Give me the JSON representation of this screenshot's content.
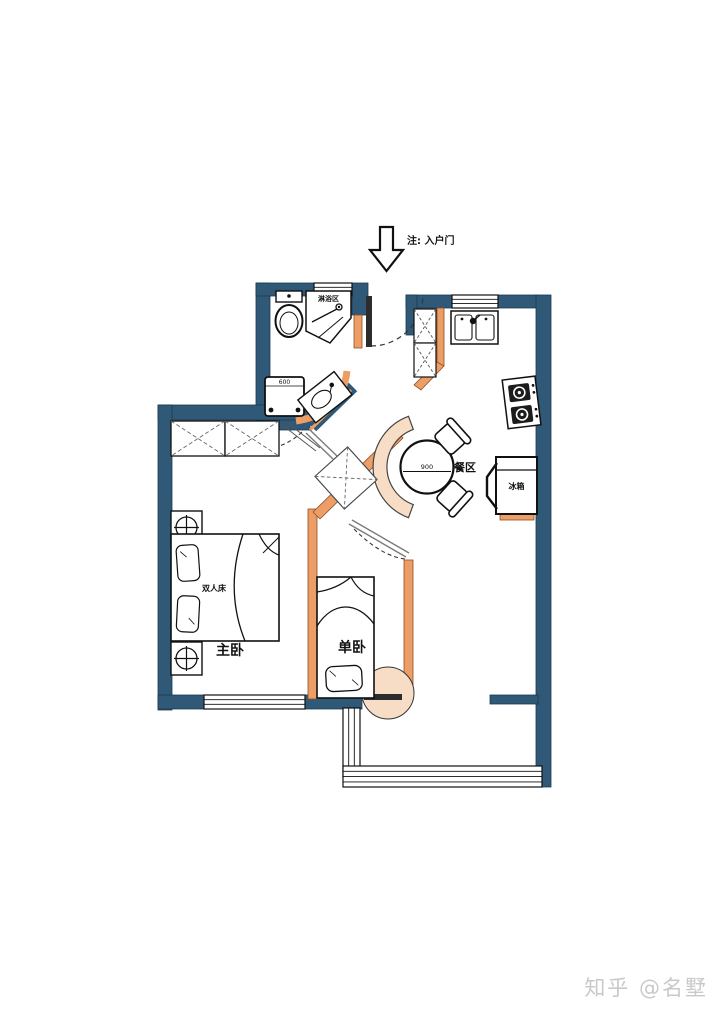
{
  "colors": {
    "wall": "#2f5977",
    "accent_orange": "#ec9e66",
    "accent_peach": "#f8ddc6",
    "line": "#111111",
    "watermark_gray": "#c9c9c9"
  },
  "entry": {
    "note": "注: 入户门"
  },
  "labels": {
    "shower_area": "淋浴区",
    "dining_area": "餐区",
    "fridge": "冰箱",
    "double_bed": "双人床",
    "master_bedroom": "主卧",
    "single_bedroom": "单卧"
  },
  "dimensions": {
    "dining_table_diameter": "900",
    "washing_machine_width": "600"
  },
  "watermark": "知乎 @名墅"
}
